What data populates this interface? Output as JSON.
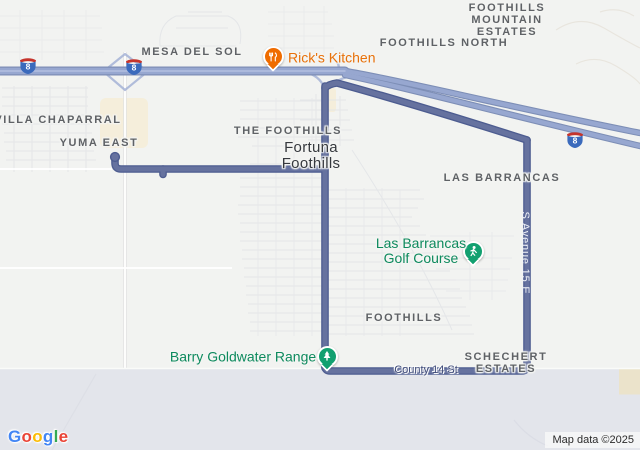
{
  "labels": {
    "villa_chaparral": "VILLA CHAPARRAL",
    "mesa_del_sol": "MESA DEL SOL",
    "yuma_east": "YUMA EAST",
    "the_foothills": "THE FOOTHILLS",
    "foothills_north": "FOOTHILLS NORTH",
    "fme_line1": "FOOTHILLS",
    "fme_line2": "MOUNTAIN",
    "fme_line3": "ESTATES",
    "fortuna_line1": "Fortuna",
    "fortuna_line2": "Foothills",
    "las_barrancas": "LAS BARRANCAS",
    "foothills_south": "FOOTHILLS",
    "schechert_line1": "SCHECHERT",
    "schechert_line2": "ESTATES"
  },
  "pois": {
    "ricks": {
      "name": "Rick's Kitchen",
      "color": "#e8710a",
      "marker_color": "#ef6c00",
      "icon": "restaurant-utensils"
    },
    "golf": {
      "line1": "Las Barrancas",
      "line2": "Golf Course",
      "color": "#0e8a5e",
      "marker_color": "#12a070",
      "icon": "golfer"
    },
    "range": {
      "name": "Barry Goldwater Range",
      "color": "#0e8a5e",
      "marker_color": "#12a070",
      "icon": "tree"
    }
  },
  "roads": {
    "county_14": "County 14 St",
    "avenue_15e": "S Avenue 15 E",
    "interstate_number": "8"
  },
  "attribution": {
    "logo_letters": [
      "G",
      "o",
      "o",
      "g",
      "l",
      "e"
    ],
    "map_data": "Map data ©2025"
  },
  "colors": {
    "background": "#f2f3f1",
    "military_area": "#e3e5eb",
    "route": "#66729f",
    "route_casing": "#4d5c90",
    "highway": "#97a7d0",
    "highway_casing": "#7d8eb6",
    "poi_label_green": "#0e8a5e",
    "poi_label_orange": "#e8710a",
    "marker_green": "#12a070",
    "marker_orange": "#ef6c00",
    "shield_blue": "#3b6abc",
    "shield_red": "#c5342c",
    "road_label_blue": "#3f4b78"
  }
}
